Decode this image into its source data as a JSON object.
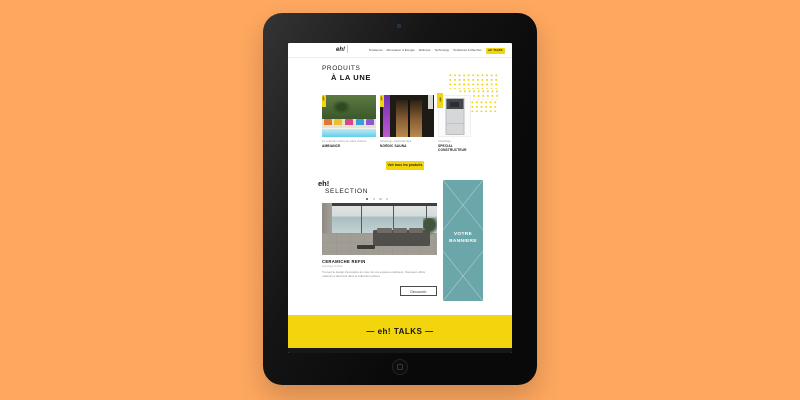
{
  "header": {
    "logo_text": "eh!",
    "nav": [
      {
        "label": "Tendances"
      },
      {
        "label": "Rénovation & Énergie"
      },
      {
        "label": "Wellness"
      },
      {
        "label": "Technology"
      },
      {
        "label": "Tendances & Marchés"
      },
      {
        "label": "eh! TALKS"
      }
    ]
  },
  "products_section": {
    "title_line1": "PRODUITS",
    "title_line2": "À LA UNE",
    "cards": [
      {
        "tag": "eh!",
        "line1": "La collection bains de soleil outdoor",
        "name": "AMBIANCE"
      },
      {
        "tag": "eh!",
        "line1": "Infrarouge Yamazuki Spa",
        "name": "NORDIC SAUNA"
      },
      {
        "tag": "eh!",
        "line1": "Chauffage",
        "name": "SPECIAL CONSTRUCTEUR"
      }
    ],
    "see_all_label": "Voir tous les produits"
  },
  "selection_section": {
    "title_line1": "eh!",
    "title_line2": "SELECTION",
    "item": {
      "title": "CERAMICHE REFIN",
      "subtitle": "Carrelage outdoor",
      "description": "Trouvez le design d'exception au cœur de vos espaces extérieurs. Nouveaux effets matières à découvrir dans la collection outdoor.",
      "button_label": "Découvrir"
    }
  },
  "ad_banner": {
    "line1": "VOTRE",
    "line2": "BANNIERE"
  },
  "talks_band": {
    "label": "—  eh! TALKS  —"
  },
  "colors": {
    "accent_yellow": "#F2D50C",
    "banner_teal": "#6BA6AB",
    "background_orange": "#FEA75F"
  }
}
